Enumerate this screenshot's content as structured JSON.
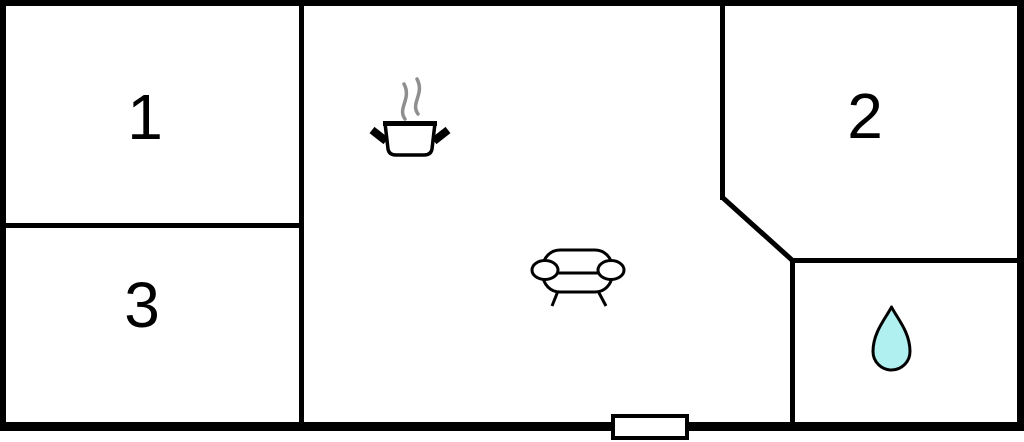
{
  "floorplan": {
    "type": "floor-plan",
    "rooms": [
      {
        "label": "1"
      },
      {
        "label": "2"
      },
      {
        "label": "3"
      }
    ],
    "icons": [
      {
        "name": "cooking-pot-icon"
      },
      {
        "name": "steam-icon"
      },
      {
        "name": "sofa-icon"
      },
      {
        "name": "water-drop-icon"
      },
      {
        "name": "entrance-door"
      }
    ],
    "colors": {
      "wall": "#000000",
      "floor": "#ffffff",
      "steam": "#8f8f8f",
      "water_drop": "#b0f0f0"
    }
  }
}
